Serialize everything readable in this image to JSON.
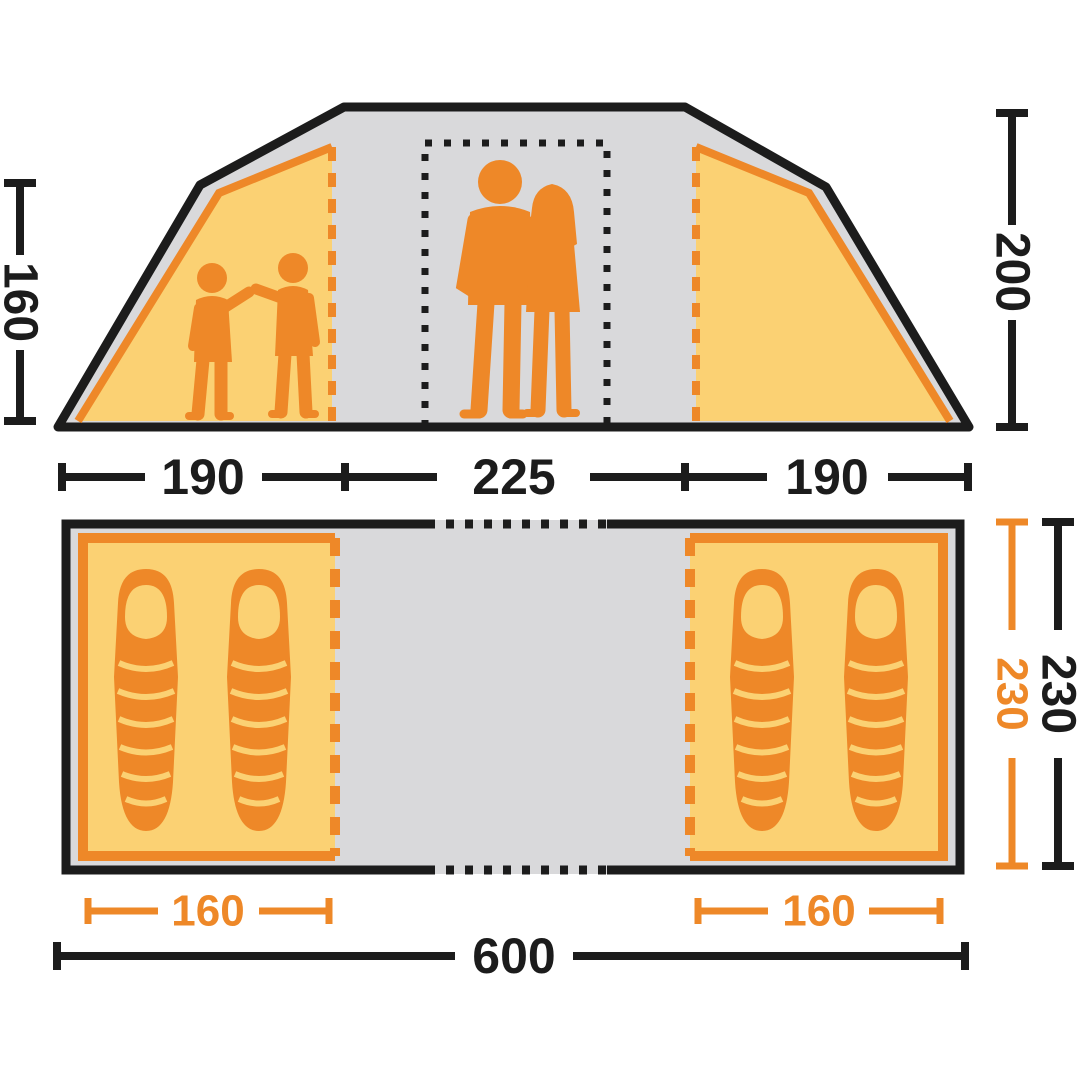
{
  "colors": {
    "orange": "#EE8828",
    "orange_light": "#FBD173",
    "gray": "#D9D9DB",
    "ink": "#1C1C1C",
    "bg": "#FFFFFF"
  },
  "elevation": {
    "inner_height": "160",
    "peak_height": "200",
    "width_left": "190",
    "width_center": "225",
    "width_right": "190",
    "figures": [
      "two-children-silhouette",
      "adult-couple-silhouette"
    ],
    "door_marker": "dotted-rectangle"
  },
  "floorplan": {
    "inner_depth": "230",
    "outer_depth": "230",
    "left_cabin_width": "160",
    "right_cabin_width": "160",
    "total_width": "600",
    "sleeping_bags_per_cabin": 2
  }
}
